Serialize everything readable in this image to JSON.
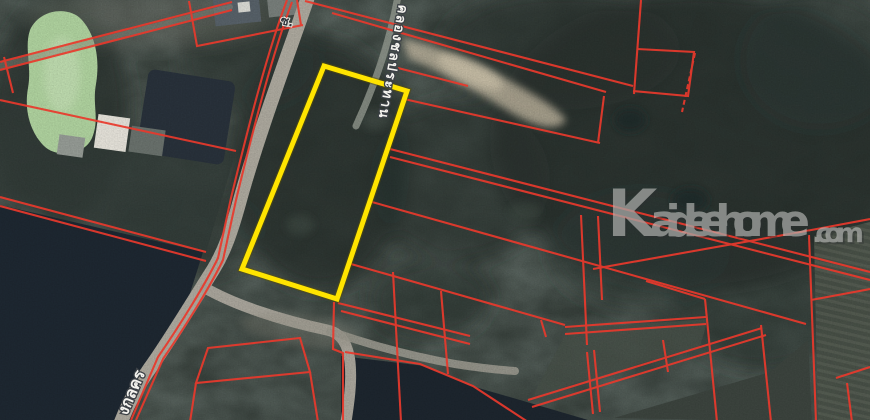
{
  "labels": {
    "canal": "คลองชลประทาน",
    "road": "งกลคร",
    "soi": "ซ."
  },
  "watermark": {
    "prefix": "K",
    "name": "aideehome",
    "tld": ".com"
  },
  "highlight": {
    "points": "324,66 407,91 337,299 242,269"
  },
  "colors": {
    "boundary": "#e9392c",
    "highlight": "#ffe400",
    "watermark": "#bfc0bd"
  }
}
